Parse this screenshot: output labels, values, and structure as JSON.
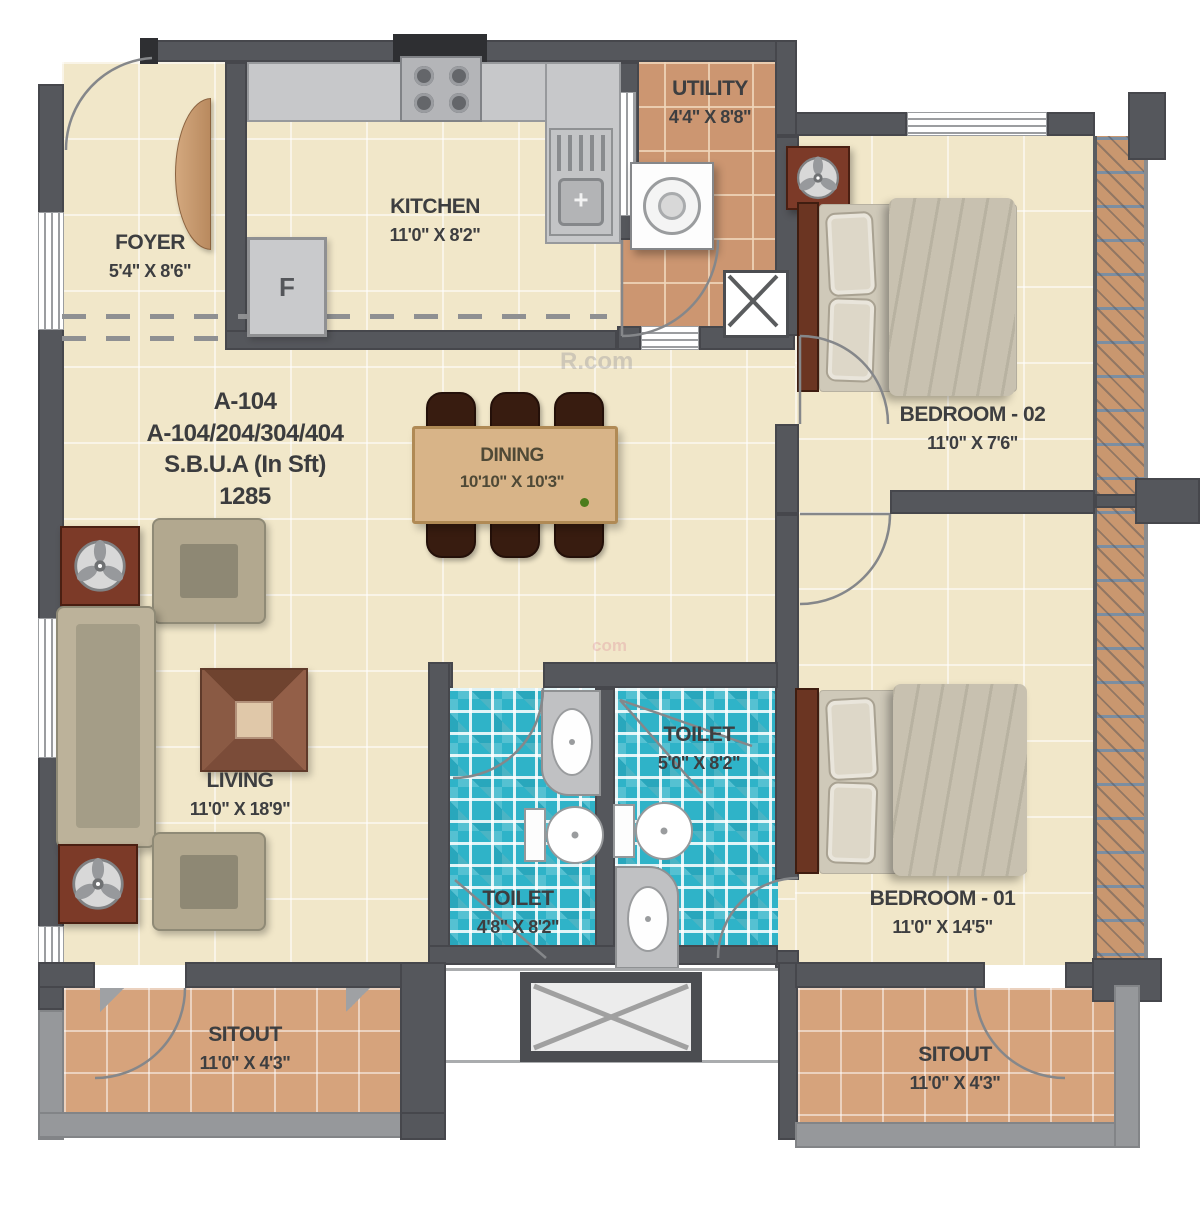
{
  "unit": {
    "title": "A-104",
    "series": "A-104/204/304/404",
    "area_label": "S.B.U.A (In Sft)",
    "area_value": "1285"
  },
  "rooms": {
    "foyer": {
      "name": "FOYER",
      "dims": "5'4\" X 8'6\""
    },
    "kitchen": {
      "name": "KITCHEN",
      "dims": "11'0\" X 8'2\""
    },
    "utility": {
      "name": "UTILITY",
      "dims": "4'4\" X 8'8\""
    },
    "bedroom2": {
      "name": "BEDROOM - 02",
      "dims": "11'0\" X 7'6\""
    },
    "dining": {
      "name": "DINING",
      "dims": "10'10\" X 10'3\""
    },
    "living": {
      "name": "LIVING",
      "dims": "11'0\" X 18'9\""
    },
    "toilet_master": {
      "name": "TOILET",
      "dims": "5'0\" X 8'2\""
    },
    "toilet_common": {
      "name": "TOILET",
      "dims": "4'8\" X 8'2\""
    },
    "bedroom1": {
      "name": "BEDROOM - 01",
      "dims": "11'0\" X 14'5\""
    },
    "sitout_left": {
      "name": "SITOUT",
      "dims": "11'0\" X 4'3\""
    },
    "sitout_right": {
      "name": "SITOUT",
      "dims": "11'0\" X 4'3\""
    }
  },
  "fixtures": {
    "fridge": "F"
  },
  "watermarks": {
    "center": "R.com",
    "small": "com"
  },
  "colors": {
    "wall": "#55575c",
    "floor_cream": "#f1e7c9",
    "tile_terracotta": "#cc9671",
    "tile_teal": "#2fb3c8",
    "wood_table": "#d8b488",
    "wood_dark": "#6b3522",
    "parapet": "#96989b"
  }
}
